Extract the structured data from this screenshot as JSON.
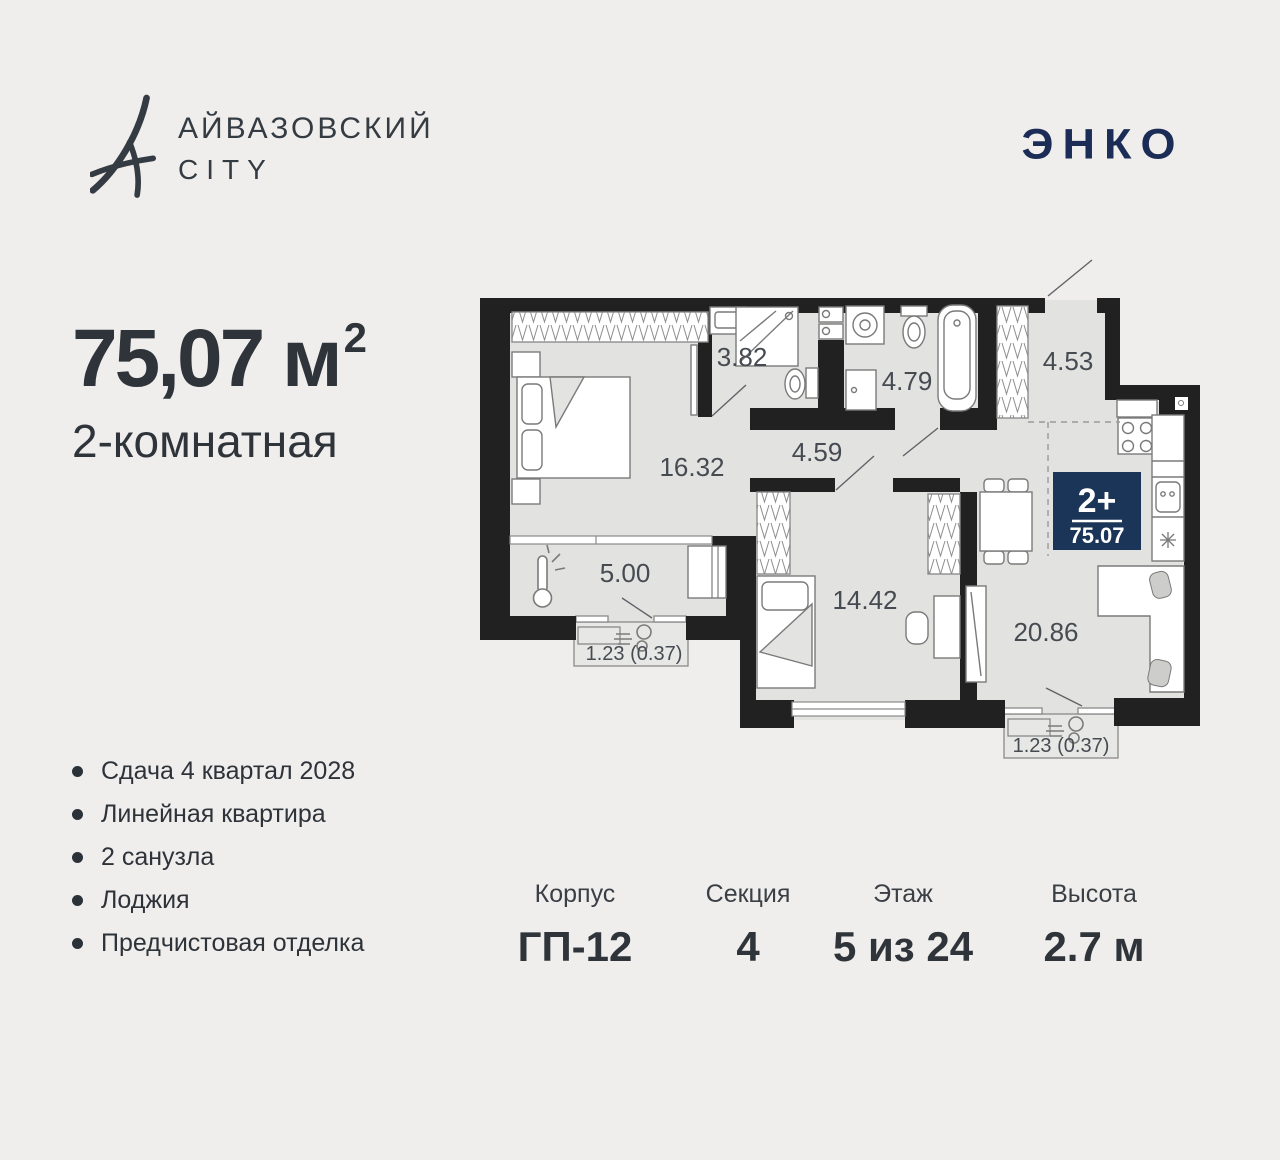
{
  "brand": {
    "line1": "АЙВАЗОВСКИЙ",
    "line2": "CITY"
  },
  "developer": {
    "logo_text": "ЭНКО"
  },
  "apartment": {
    "area_value": "75,07",
    "area_unit": "м",
    "area_sup": "2",
    "type": "2-комнатная"
  },
  "features": {
    "items": [
      "Сдача 4 квартал 2028",
      "Линейная квартира",
      "2 санузла",
      "Лоджия",
      "Предчистовая отделка"
    ]
  },
  "specs": {
    "items": [
      {
        "label": "Корпус",
        "value": "ГП-12"
      },
      {
        "label": "Секция",
        "value": "4"
      },
      {
        "label": "Этаж",
        "value": "5 из 24"
      },
      {
        "label": "Высота",
        "value": "2.7 м"
      }
    ]
  },
  "plan": {
    "badge": {
      "rooms": "2+",
      "area": "75.07"
    },
    "labels": {
      "bedroom": "16.32",
      "bath_small": "3.82",
      "bath_big": "4.79",
      "hallway": "4.53",
      "corridor": "4.59",
      "loggia": "5.00",
      "bedroom2": "14.42",
      "kitchen_living": "20.86",
      "balcony_left": "1.23 (0.37)",
      "balcony_right": "1.23 (0.37)"
    },
    "colors": {
      "wall": "#212121",
      "floor": "#e2e2e0",
      "badge": "#1a3557",
      "navy": "#1b2c57"
    }
  }
}
